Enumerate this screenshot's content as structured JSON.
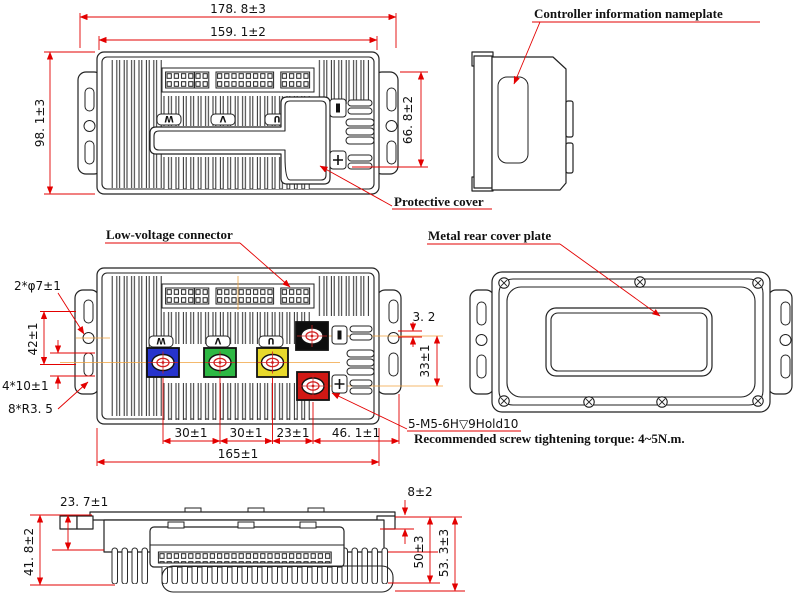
{
  "drawing": {
    "colors": {
      "outline": "#222222",
      "dimension_red": "#e30000",
      "centerline_orange": "#f0a23c",
      "terminal_blue": "#2633cc",
      "terminal_green": "#2eb843",
      "terminal_yellow": "#e8d92b",
      "terminal_black": "#0d0d0d",
      "terminal_red": "#d01814"
    },
    "top_view": {
      "dim_overall_width": "178. 8±3",
      "dim_body_width": "159. 1±2",
      "dim_overall_height": "98. 1±3",
      "dim_side_height": "66. 8±2",
      "protective_cover_label": "Protective cover",
      "terminal_w": "W",
      "terminal_v": "V",
      "terminal_u": "U"
    },
    "side_view": {
      "nameplate_label": "Controller information nameplate"
    },
    "front_view": {
      "low_voltage_label": "Low-voltage connector",
      "dim_mount_holes": "2*φ7±1",
      "dim_slot_spacing": "42±1",
      "dim_slot_size": "4*10±1",
      "dim_corner_radius": "8*R3. 5",
      "dim_step": "3. 2",
      "dim_terminal_spacing": "33±1",
      "dim_w_to_v": "30±1",
      "dim_v_to_u": "30±1",
      "dim_u_to_b": "23±1",
      "dim_b_to_edge": "46. 1±1",
      "dim_mount_span": "165±1",
      "screw_spec_note": "5-M5-6H▽9Hold10",
      "torque_note": "Recommended screw tightening torque:  4~5N.m.",
      "terminal_w": "W",
      "terminal_v": "V",
      "terminal_u": "U"
    },
    "rear_view": {
      "cover_label": "Metal rear cover plate"
    },
    "bottom_view": {
      "dim_flange_to_base": "23. 7±1",
      "dim_left_height": "41. 8±2",
      "dim_flange_thickness": "8±2",
      "dim_fin_height": "50±3",
      "dim_total_height": "53. 3±3"
    }
  }
}
